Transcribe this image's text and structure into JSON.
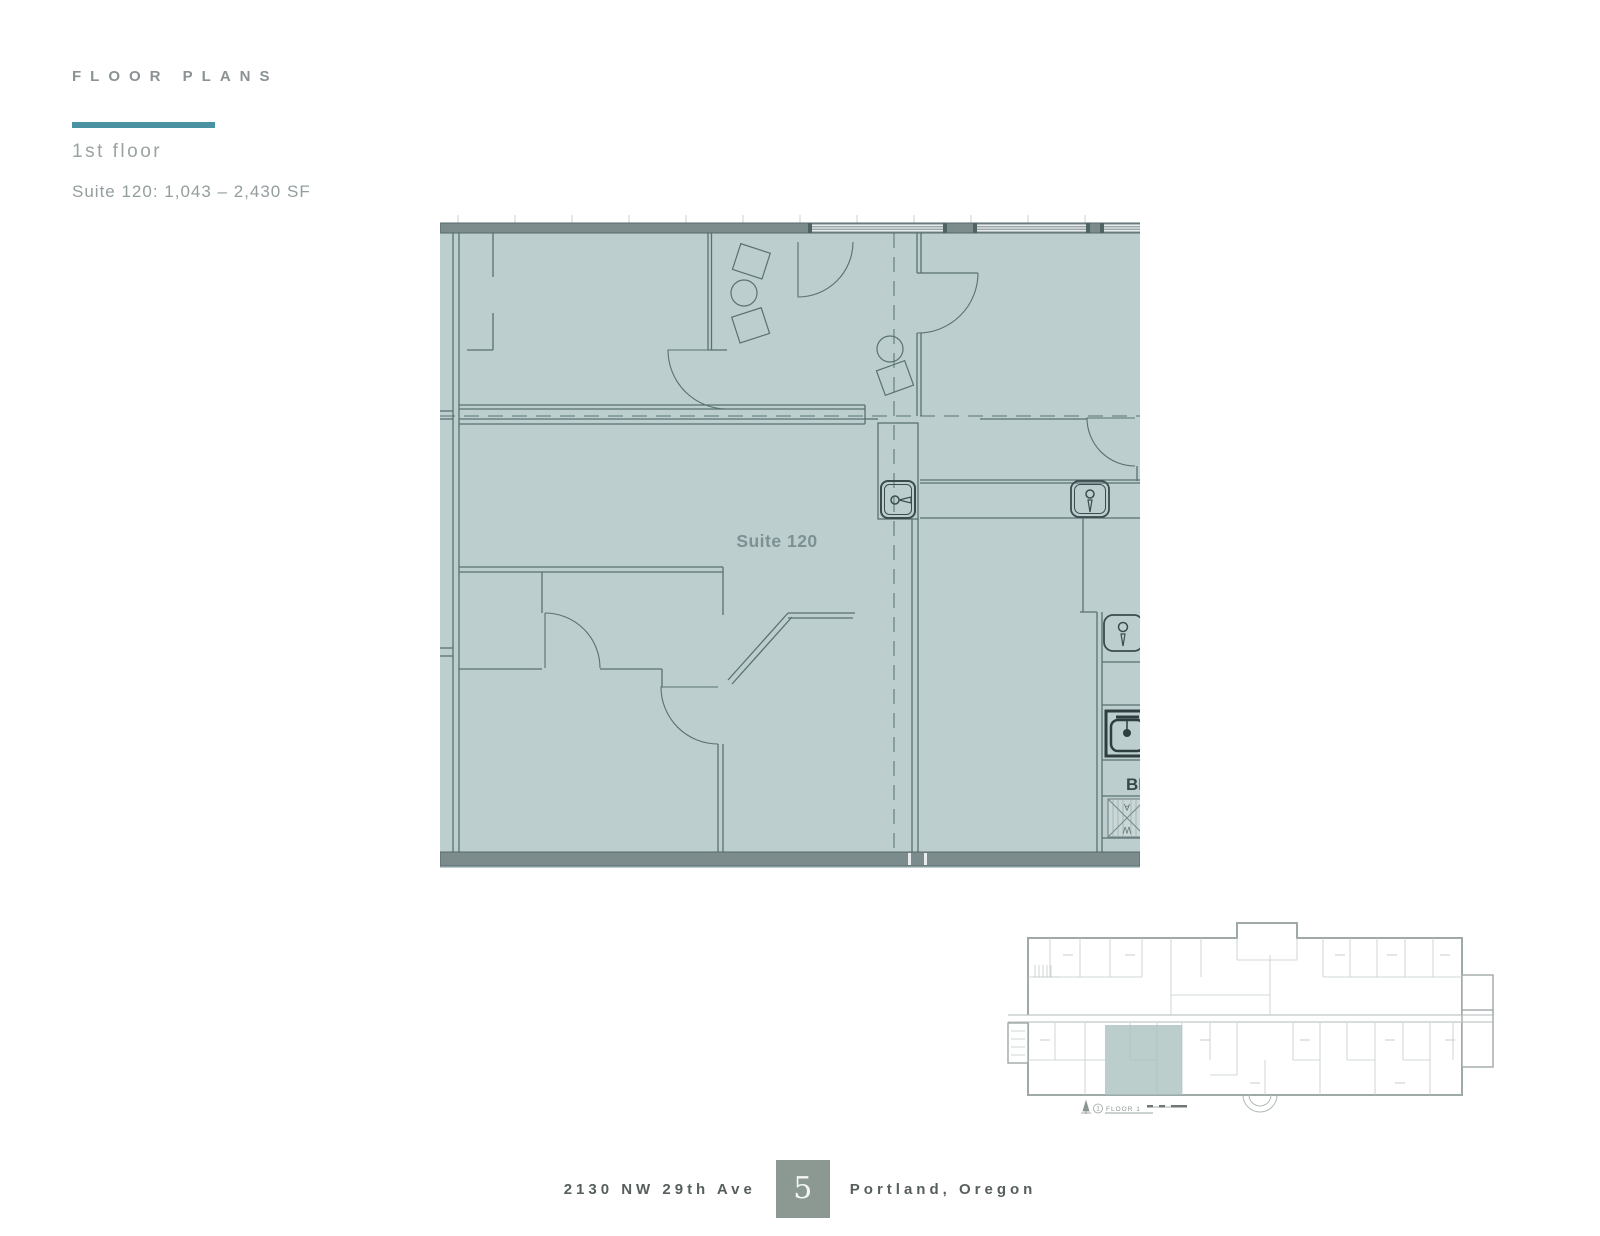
{
  "header": {
    "title": "FLOOR PLANS",
    "floor_label": "1st floor",
    "suite_info": "Suite 120: 1,043 – 2,430 SF"
  },
  "plan": {
    "suite_label": "Suite 120",
    "break_label": "BI",
    "washer_top": "A",
    "washer_bottom": "W"
  },
  "overview": {
    "floor_number": "1",
    "caption": "FLOOR 1"
  },
  "footer": {
    "address": "2130 NW 29th Ave",
    "page_number": "5",
    "city": "Portland, Oregon"
  },
  "colors": {
    "accent_teal": "#4b93a2",
    "plan_fill": "#bccfce",
    "wall_line": "#5a7072",
    "thick_wall": "#7c8c8d",
    "suite_label_gray": "#7d9093",
    "mini_highlight": "#a8c0be",
    "page_box_gray": "#8c9993",
    "footer_text": "#565f5d"
  }
}
